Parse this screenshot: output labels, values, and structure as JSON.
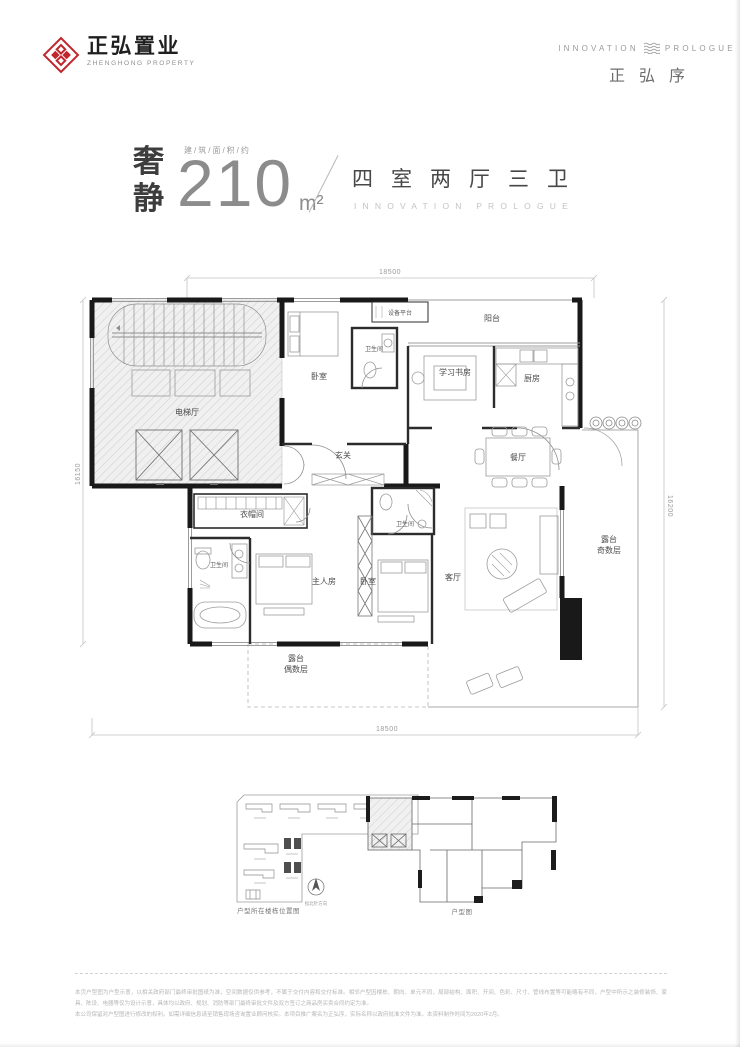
{
  "brand": {
    "logo_cn": "正弘置业",
    "logo_en": "ZHENGHONG PROPERTY",
    "right_en_left": "INNOVATION",
    "right_en_right": "PROLOGUE",
    "right_cn": "正弘序"
  },
  "title": {
    "tag_line1": "奢",
    "tag_line2": "静",
    "area_label": "建/筑/面/积/约",
    "area_value": "210",
    "area_unit": "m²",
    "rooms_cn": "四室两厅三卫",
    "rooms_en": "INNOVATION PROLOGUE"
  },
  "floorplan": {
    "dims": {
      "top": "18500",
      "bottom": "18500",
      "left": "16150",
      "right": "16200"
    },
    "rooms": [
      {
        "id": "elevator-hall",
        "label": "电梯厅",
        "x": 115,
        "y": 157
      },
      {
        "id": "bedroom-north",
        "label": "卧室",
        "x": 247,
        "y": 121
      },
      {
        "id": "bath-north",
        "label": "卫生间",
        "x": 302,
        "y": 93,
        "small": true
      },
      {
        "id": "equip-platform",
        "label": "设备平台",
        "x": 328,
        "y": 57,
        "small": true
      },
      {
        "id": "balcony",
        "label": "阳台",
        "x": 420,
        "y": 63
      },
      {
        "id": "study",
        "label": "学习书房",
        "x": 383,
        "y": 117
      },
      {
        "id": "kitchen",
        "label": "厨房",
        "x": 460,
        "y": 123
      },
      {
        "id": "dining",
        "label": "餐厅",
        "x": 446,
        "y": 202
      },
      {
        "id": "foyer",
        "label": "玄关",
        "x": 271,
        "y": 200
      },
      {
        "id": "cloak-room",
        "label": "衣帽间",
        "x": 180,
        "y": 259
      },
      {
        "id": "bath-master",
        "label": "卫生间",
        "x": 147,
        "y": 309,
        "small": true
      },
      {
        "id": "master-bedroom",
        "label": "主人房",
        "x": 252,
        "y": 326
      },
      {
        "id": "bedroom-south",
        "label": "卧室",
        "x": 296,
        "y": 326
      },
      {
        "id": "bath-south",
        "label": "卫生间",
        "x": 333,
        "y": 268,
        "small": true
      },
      {
        "id": "living",
        "label": "客厅",
        "x": 381,
        "y": 322
      },
      {
        "id": "terrace-odd",
        "lines": [
          "露台",
          "奇数层"
        ],
        "x": 537,
        "y": 284
      },
      {
        "id": "terrace-even",
        "lines": [
          "露台",
          "偶数层"
        ],
        "x": 224,
        "y": 403
      }
    ]
  },
  "footer": {
    "site_caption": "户型所在楼栋位置图",
    "mini_caption": "户型图",
    "compass_label": "指北针方向",
    "disclaimer1": "本页户型图为户型示意，以相关政府部门最终审批图纸为准，空间数据仅供参考，不属于交付内容和交付标准。相邻户型因楼栋、朝向、单元不同，局部结构、面积、开间、色彩、尺寸、管线布置等可能略有不同，户型中所示之装修装饰、家具、陈设、电器等仅为设计示意，具体均以政府、规划、消防等部门最终审批文件及双方签订之商品房买卖合同约定为准。",
    "disclaimer2": "本公司保留对户型图进行修改的权利。如需详细信息请至销售现场咨询置业顾问核实。本项目推广案名为正弘序，实际名称以政府批准文件为准。本资料制作时间为2020年2月。"
  }
}
